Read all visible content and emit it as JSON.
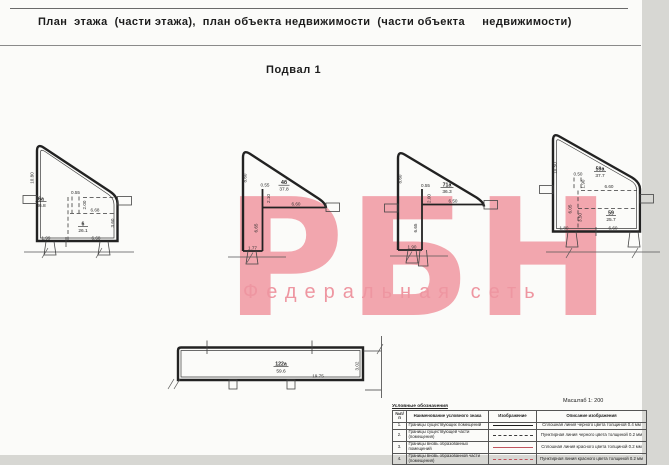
{
  "page": {
    "title": "План  этажа  (части этажа),  план объекта недвижимости  (части объекта     недвижимости)",
    "floor_label": "Подвал 1",
    "scale_label": "Масштаб  1: 200"
  },
  "watermark": {
    "logo": "РБН",
    "subtitle": "Федеральная  сеть",
    "color": "#f2a6ae"
  },
  "plan": {
    "shapes": [
      {
        "name": "room-6",
        "rooms": [
          {
            "num": "6а",
            "area": "36.8"
          },
          {
            "num": "6",
            "area": "26.1"
          }
        ],
        "dims": [
          "10.80",
          "0.55",
          "2.00",
          "6.68",
          "3.60",
          "1.99",
          "6.68"
        ]
      },
      {
        "name": "room-4b",
        "rooms": [
          {
            "num": "4б",
            "area": "37.8"
          }
        ],
        "dims": [
          "8.60",
          "0.55",
          "2.10",
          "6.60",
          "6.65",
          "1.77"
        ]
      },
      {
        "name": "room-71a",
        "rooms": [
          {
            "num": "71а",
            "area": "36.3"
          }
        ],
        "dims": [
          "8.60",
          "0.55",
          "2.00",
          "6.50",
          "6.65",
          "1.90"
        ]
      },
      {
        "name": "room-59",
        "rooms": [
          {
            "num": "59а",
            "area": "37.7"
          },
          {
            "num": "59",
            "area": "25.7"
          }
        ],
        "dims": [
          "10.50",
          "0.50",
          "1.90",
          "6.60",
          "6.05",
          "3.50",
          "1.80",
          "6.60"
        ]
      },
      {
        "name": "room-122a",
        "rooms": [
          {
            "num": "122а",
            "area": "59.6"
          }
        ],
        "dims": [
          "19.75",
          "3.02"
        ]
      }
    ]
  },
  "legend": {
    "heading": "Условные обозначения",
    "headers": [
      "№п/п",
      "Наименование условного знака",
      "Изображение",
      "Описание изображения"
    ],
    "rows": [
      {
        "num": "1.",
        "name": "Границы существующих помещений",
        "style": "solid-black",
        "desc": "Сплошная линия черного цвета толщиной 0.4 мм"
      },
      {
        "num": "2.",
        "name": "Границы существующей части (помещения)",
        "style": "dashed-black",
        "desc": "Пунктирная линия черного цвета толщиной 0.2 мм"
      },
      {
        "num": "3.",
        "name": "Границы вновь образованных помещений",
        "style": "solid-red",
        "desc": "Сплошная линия красного цвета толщиной 0.2 мм"
      },
      {
        "num": "4.",
        "name": "Границы вновь образованной части (помещения)",
        "style": "dashed-red",
        "desc": "Пунктирная линия красного цвета толщиной 0.2 мм"
      }
    ]
  }
}
